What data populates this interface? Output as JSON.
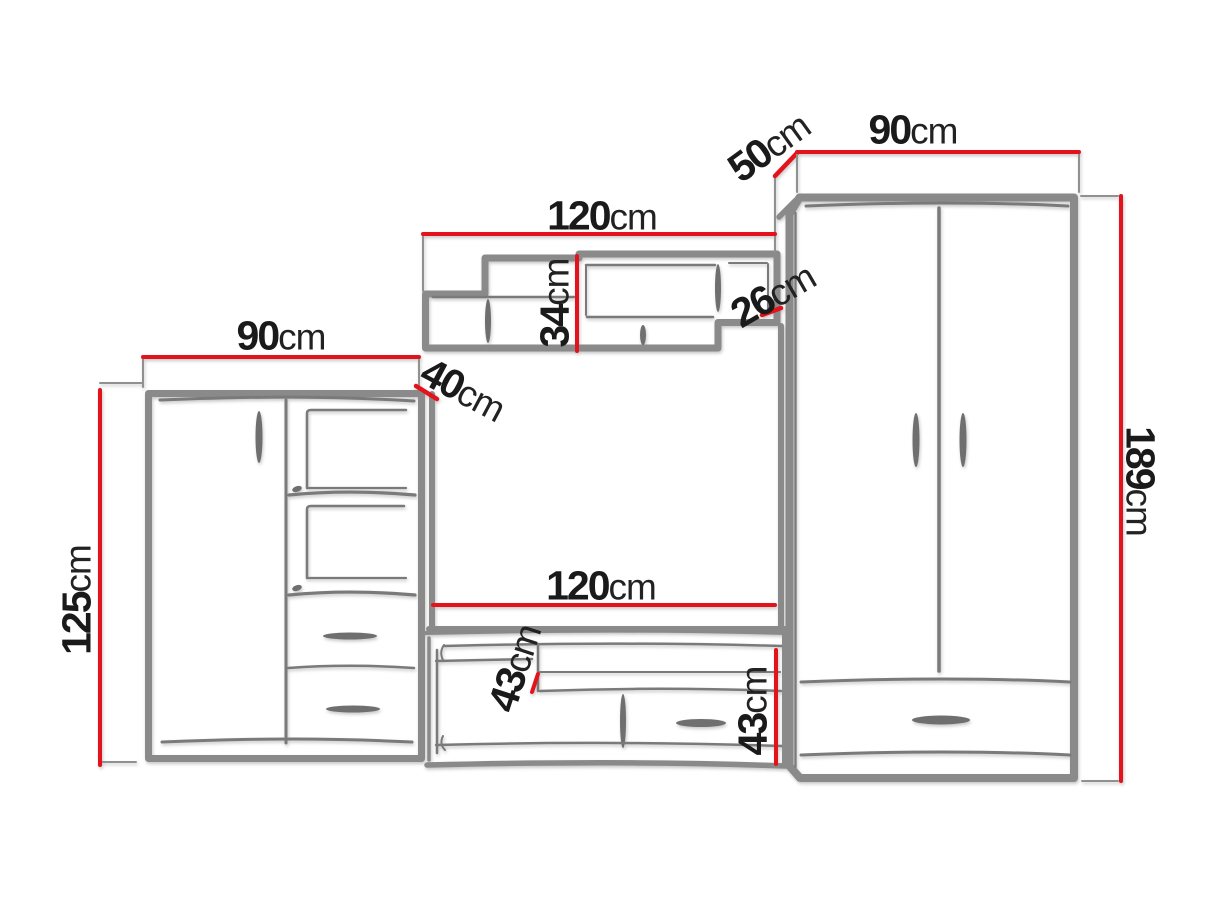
{
  "diagram": {
    "kind": "furniture-wall-unit-dimension-drawing",
    "default_unit": "cm",
    "colors": {
      "dimension_line": "#e3131b",
      "outline_gray": "#8a8a8a",
      "sketch_gray": "#7a7a7a",
      "label_text": "#1a1a1a",
      "background": "#ffffff"
    },
    "dimensions": {
      "left_cabinet_width": {
        "value": "90",
        "unit": "cm"
      },
      "left_cabinet_height": {
        "value": "125",
        "unit": "cm"
      },
      "left_cabinet_depth": {
        "value": "40",
        "unit": "cm"
      },
      "wall_shelf_width": {
        "value": "120",
        "unit": "cm"
      },
      "wall_shelf_height": {
        "value": "34",
        "unit": "cm"
      },
      "wall_shelf_right_height": {
        "value": "26",
        "unit": "cm"
      },
      "wardrobe_depth": {
        "value": "50",
        "unit": "cm"
      },
      "wardrobe_width": {
        "value": "90",
        "unit": "cm"
      },
      "wardrobe_height": {
        "value": "189",
        "unit": "cm"
      },
      "tv_niche_width": {
        "value": "120",
        "unit": "cm"
      },
      "tv_stand_depth": {
        "value": "43",
        "unit": "cm"
      },
      "tv_stand_height": {
        "value": "43",
        "unit": "cm"
      }
    }
  }
}
